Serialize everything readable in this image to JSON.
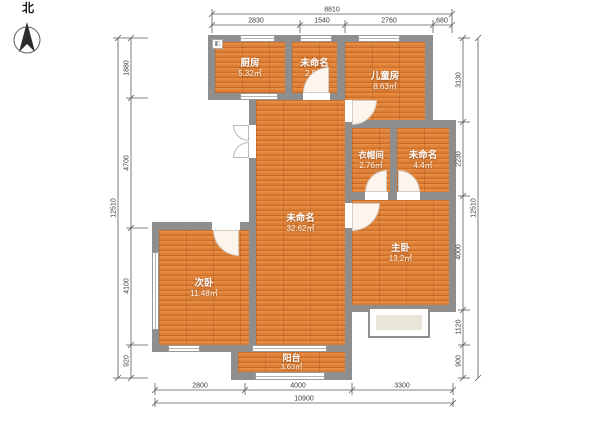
{
  "compass": {
    "label": "北"
  },
  "rooms": {
    "kitchen": {
      "name": "厨房",
      "area": "5.32㎡"
    },
    "unnamed_small": {
      "name": "未命名",
      "area": "2.9㎡"
    },
    "children": {
      "name": "儿童房",
      "area": "8.63㎡"
    },
    "cloakroom": {
      "name": "衣帽间",
      "area": "2.76㎡"
    },
    "unnamed_mid": {
      "name": "未命名",
      "area": "4.4㎡"
    },
    "living": {
      "name": "未命名",
      "area": "32.62㎡"
    },
    "master": {
      "name": "主卧",
      "area": "13.2㎡"
    },
    "second": {
      "name": "次卧",
      "area": "11.48㎡"
    },
    "balcony": {
      "name": "阳台",
      "area": "3.63㎡"
    }
  },
  "dimensions": {
    "top": {
      "total": "8810",
      "segments": [
        "2830",
        "1540",
        "2760",
        "680"
      ]
    },
    "left": {
      "total": "12510",
      "segments": [
        "1880",
        "4700",
        "4100",
        "920"
      ]
    },
    "right": {
      "total": "12510",
      "segments": [
        "3130",
        "2230",
        "4000",
        "1120",
        "900"
      ]
    },
    "bottom": {
      "total": "10900",
      "segments": [
        "2800",
        "4000",
        "3300"
      ]
    }
  },
  "colors": {
    "wall": "#8e8e8e",
    "floor": "#e08238",
    "bay_fill": "#e9e5d8",
    "dim_text": "#3c3c3c"
  }
}
